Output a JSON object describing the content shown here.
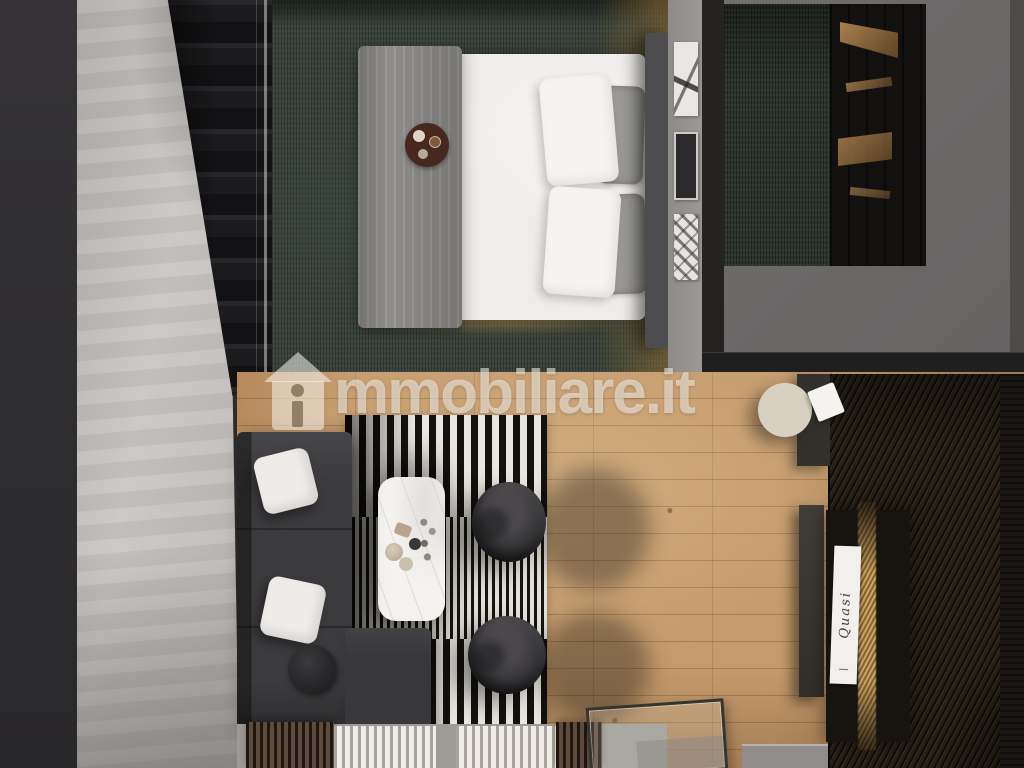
{
  "watermark": {
    "icon": "house-icon",
    "text_after_icon": "mmobiliare.it",
    "full_text": "immobiliare.it"
  },
  "wall_sign": {
    "text": "Quasi"
  },
  "palette": {
    "concrete_wall": "#c4c0bd",
    "dark_side_strip": "#343236",
    "stairs": "#1b1a1c",
    "bedroom_carpet": "#39413b",
    "bed_linen": "#efedeb",
    "blanket_gray": "#8e8d8b",
    "headboard": "#4d4c4e",
    "gold_glow": "#e0ab62",
    "wood_floor": "#c59b6d",
    "rug_black": "#14120e",
    "rug_white": "#e9e6e0",
    "sofa_charcoal": "#3b3a3c",
    "slat_wall": "#251f17",
    "watermark_white": "rgba(250,248,244,0.55)"
  }
}
